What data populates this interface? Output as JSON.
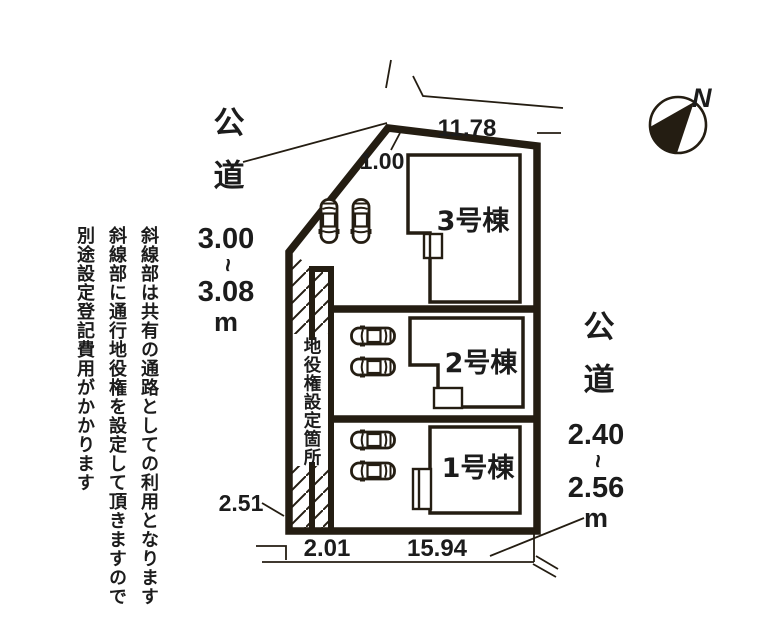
{
  "colors": {
    "ink": "#241d12",
    "text": "#1c1c1c",
    "paper": "#ffffff"
  },
  "note_left": {
    "line1": "斜線部は共有の通路としての利用となります",
    "line2": "斜線部に通行地役権を設定して頂きますので",
    "line3": "別途設定登記費用がかかります"
  },
  "easement": {
    "label": "地役権設定箇所"
  },
  "road_left": {
    "kanji": "公道",
    "min": "3.00",
    "tilde": "~",
    "max": "3.08",
    "unit": "m"
  },
  "road_right": {
    "kanji": "公道",
    "min": "2.40",
    "tilde": "~",
    "max": "2.56",
    "unit": "m"
  },
  "compass": {
    "north": "N"
  },
  "dimensions": {
    "top_frontage": "11.78",
    "top_corner": "1.00",
    "left_corner": "2.51",
    "passage_width": "2.01",
    "bottom_frontage": "15.94"
  },
  "buildings": [
    {
      "label": "3号棟"
    },
    {
      "label": "2号棟"
    },
    {
      "label": "1号棟"
    }
  ]
}
